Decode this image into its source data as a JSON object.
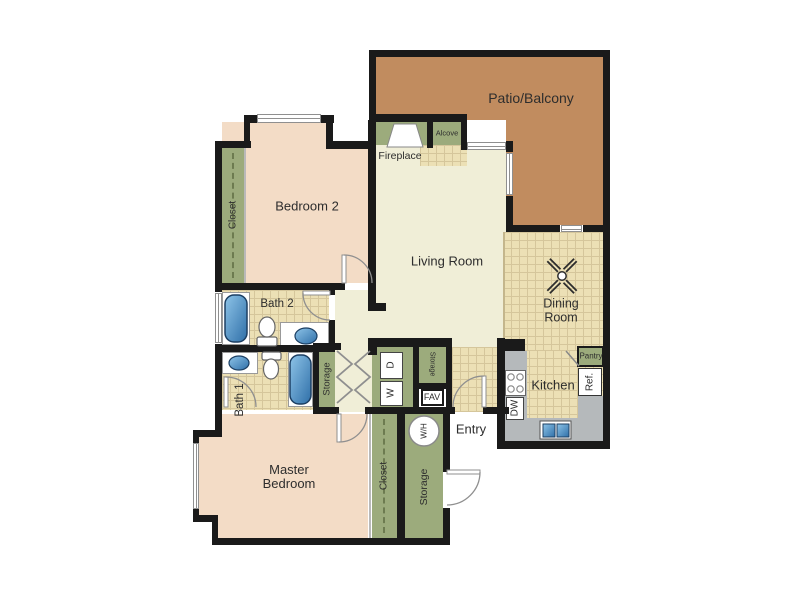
{
  "plan": {
    "title": "apartment-floor-plan",
    "labels": {
      "patio_balcony": "Patio/Balcony",
      "bedroom2": "Bedroom 2",
      "living_room": "Living Room",
      "dining_room": "Dining Room",
      "master_bedroom": "Master Bedroom",
      "kitchen": "Kitchen",
      "entry": "Entry",
      "bath1": "Bath 1",
      "bath2": "Bath 2",
      "fireplace": "Fireplace",
      "alcove": "Alcove",
      "pantry": "Pantry",
      "refrigerator": "Ref.",
      "dishwasher": "DW",
      "washer": "W",
      "dryer": "D",
      "fav": "FAV",
      "water_heater": "W/H",
      "storage_hall": "Storage",
      "storage_hall_upper": "Storage",
      "storage_entry": "Storage",
      "closet_bedroom2": "Closet",
      "closet_master": "Closet"
    },
    "colors": {
      "wall": "#1a1a1a",
      "bedroom_floor": "#f3dcc6",
      "living_floor": "#f0eed7",
      "tile_floor": "#ece0b5",
      "tile_line": "#d5c69b",
      "closet_green": "#9cab7c",
      "patio_brown": "#c18c5f",
      "counter_gray": "#b5b9bb",
      "fixture_blue_dark": "#2f6fa8",
      "fixture_blue_light": "#8ec4e8"
    },
    "icons": [
      "bathtub-icon",
      "toilet-icon",
      "sink-icon",
      "stove-icon",
      "kitchen-sink-icon",
      "ceiling-fan-icon",
      "fireplace-icon",
      "door-swing-icon",
      "bifold-door-icon",
      "water-heater-icon",
      "window"
    ]
  }
}
